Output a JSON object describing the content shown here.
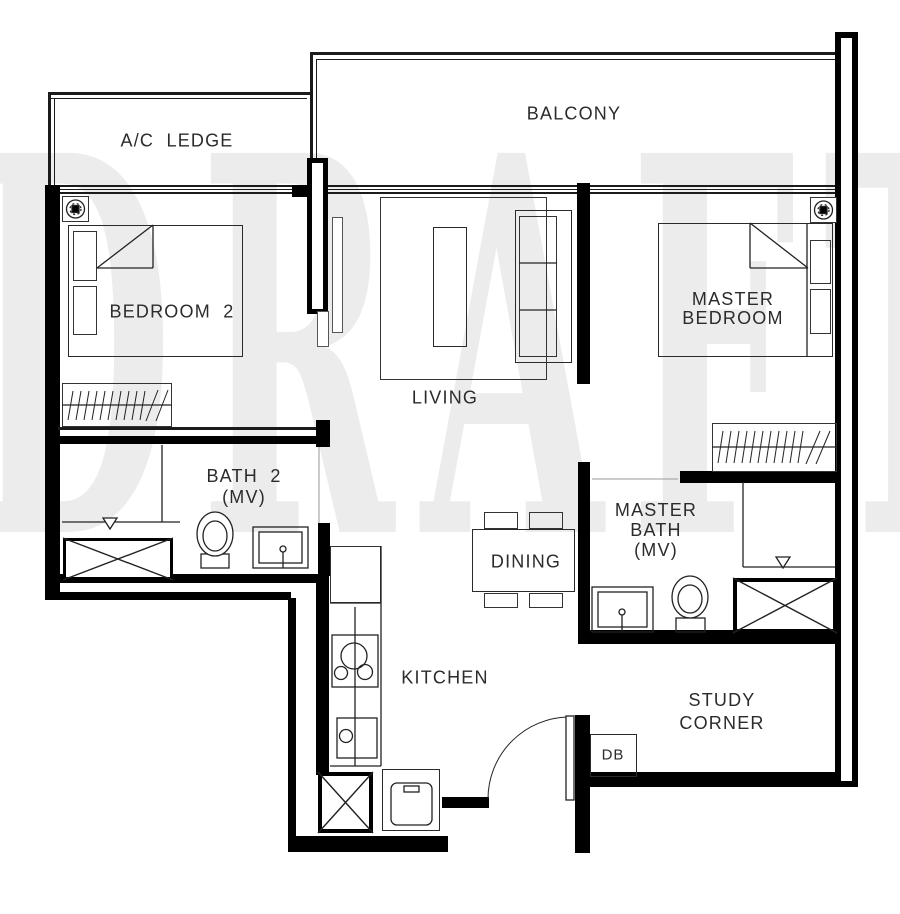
{
  "watermark": "DRAFT",
  "colors": {
    "wall": "#000000",
    "thin_line": "#1b1b1b",
    "furniture_line": "#333333",
    "label": "#2b2b2b"
  },
  "rooms": {
    "ac_ledge": {
      "label": "A/C  LEDGE"
    },
    "balcony": {
      "label": "BALCONY"
    },
    "bedroom2": {
      "label": "BEDROOM  2"
    },
    "master_bedroom": {
      "label": "MASTER\nBEDROOM"
    },
    "living": {
      "label": "LIVING"
    },
    "bath2": {
      "label": "BATH  2\n(MV)"
    },
    "master_bath": {
      "label": "MASTER\nBATH\n(MV)"
    },
    "dining": {
      "label": "DINING"
    },
    "kitchen": {
      "label": "KITCHEN"
    },
    "study_corner": {
      "label": "STUDY\nCORNER"
    },
    "db": {
      "label": "DB"
    }
  }
}
